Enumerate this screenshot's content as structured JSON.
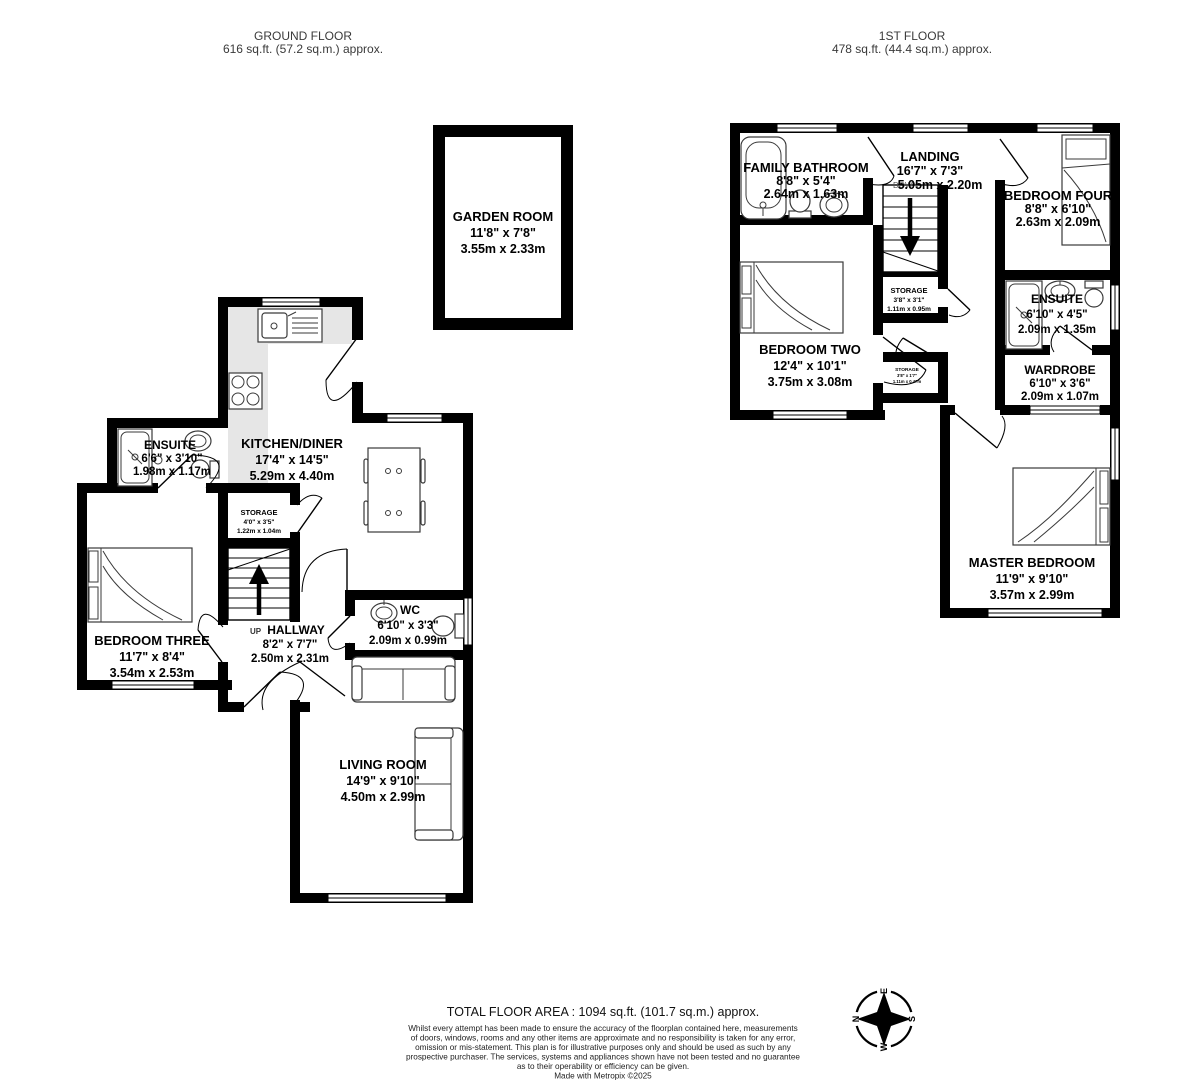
{
  "floors": {
    "ground": {
      "title": "GROUND FLOOR",
      "area": "616 sq.ft. (57.2 sq.m.) approx."
    },
    "first": {
      "title": "1ST FLOOR",
      "area": "478 sq.ft. (44.4 sq.m.) approx."
    }
  },
  "rooms": {
    "garden_room": {
      "name": "GARDEN ROOM",
      "imperial": "11'8\" x 7'8\"",
      "metric": "3.55m x 2.33m"
    },
    "kitchen_diner": {
      "name": "KITCHEN/DINER",
      "imperial": "17'4\" x 14'5\"",
      "metric": "5.29m x 4.40m"
    },
    "ensuite_gf": {
      "name": "ENSUITE",
      "imperial": "6'6\" x 3'10\"",
      "metric": "1.98m x 1.17m"
    },
    "storage_gf": {
      "name": "STORAGE",
      "imperial": "4'0\" x 3'5\"",
      "metric": "1.22m x 1.04m"
    },
    "bedroom_three": {
      "name": "BEDROOM THREE",
      "imperial": "11'7\" x 8'4\"",
      "metric": "3.54m x 2.53m"
    },
    "hallway": {
      "up": "UP",
      "name": "HALLWAY",
      "imperial": "8'2\" x 7'7\"",
      "metric": "2.50m x 2.31m"
    },
    "wc": {
      "name": "WC",
      "imperial": "6'10\" x 3'3\"",
      "metric": "2.09m x 0.99m"
    },
    "living_room": {
      "name": "LIVING ROOM",
      "imperial": "14'9\" x 9'10\"",
      "metric": "4.50m x 2.99m"
    },
    "family_bathroom": {
      "name": "FAMILY BATHROOM",
      "imperial": "8'8\" x 5'4\"",
      "metric": "2.64m x 1.63m"
    },
    "landing": {
      "name": "LANDING",
      "down": "DOWN",
      "imperial": "16'7\" x 7'3\"",
      "metric": "5.05m x 2.20m"
    },
    "bedroom_four": {
      "name": "BEDROOM FOUR",
      "imperial": "8'8\" x 6'10\"",
      "metric": "2.63m x 2.09m"
    },
    "storage_1f": {
      "name": "STORAGE",
      "imperial": "3'8\" x 3'1\"",
      "metric": "1.11m x 0.95m"
    },
    "storage_1f_small": {
      "name": "STORAGE",
      "imperial": "3'8\" x 1'7\"",
      "metric": "1.11m x 0.47m"
    },
    "bedroom_two": {
      "name": "BEDROOM TWO",
      "imperial": "12'4\" x 10'1\"",
      "metric": "3.75m x 3.08m"
    },
    "ensuite_1f": {
      "name": "ENSUITE",
      "imperial": "6'10\" x 4'5\"",
      "metric": "2.09m x 1.35m"
    },
    "wardrobe": {
      "name": "WARDROBE",
      "imperial": "6'10\" x 3'6\"",
      "metric": "2.09m x 1.07m"
    },
    "master_bedroom": {
      "name": "MASTER BEDROOM",
      "imperial": "11'9\" x 9'10\"",
      "metric": "3.57m x 2.99m"
    }
  },
  "compass": {
    "n": "N",
    "e": "E",
    "s": "S",
    "w": "W"
  },
  "footer": {
    "total": "TOTAL FLOOR AREA : 1094 sq.ft. (101.7 sq.m.) approx.",
    "disclaimer_lines": [
      "Whilst every attempt has been made to ensure the accuracy of the floorplan contained here, measurements",
      "of doors, windows, rooms and any other items are approximate and no responsibility is taken for any error,",
      "omission or mis-statement. This plan is for illustrative purposes only and should be used as such by any",
      "prospective purchaser. The services, systems and appliances shown have not been tested and no guarantee",
      "as to their operability or efficiency can be given."
    ],
    "credit": "Made with Metropix ©2025"
  },
  "colors": {
    "wall": "#000000",
    "counter": "#e6e6e6",
    "text": "#000000"
  }
}
